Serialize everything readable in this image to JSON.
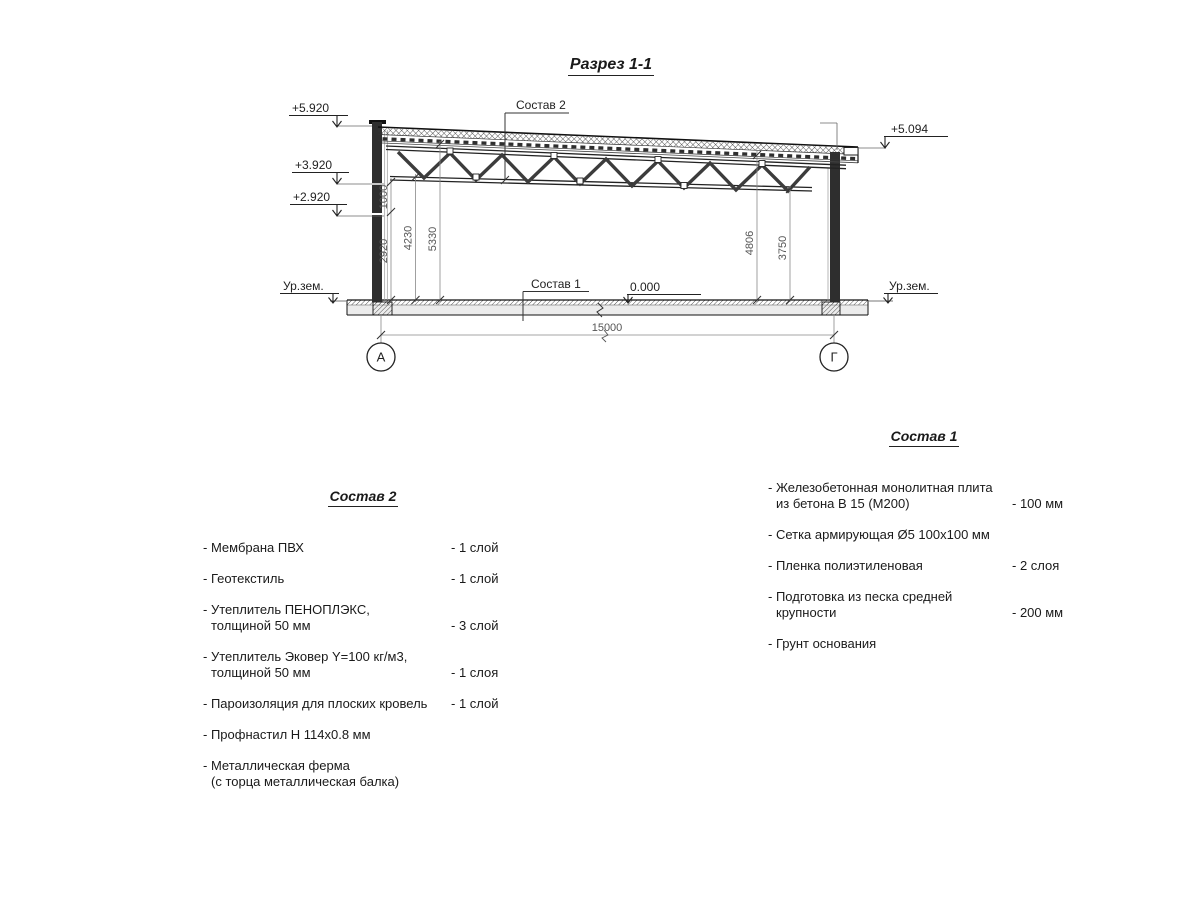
{
  "title": "Разрез 1-1",
  "section": {
    "elevations": {
      "left_top": "+5.920",
      "left_mid": "+3.920",
      "left_low": "+2.920",
      "right_top": "+5.094",
      "zero": "0.000"
    },
    "ground_level_left": "Ур.зем.",
    "ground_level_right": "Ур.зем.",
    "callout_roof": "Состав 2",
    "callout_floor": "Состав 1",
    "dims": {
      "d1000": "1000",
      "d2920": "2920",
      "d4230": "4230",
      "d5330": "5330",
      "d4806": "4806",
      "d3750": "3750",
      "span": "15000"
    },
    "axes": {
      "left": "А",
      "right": "Г"
    }
  },
  "list2": {
    "heading": "Состав 2",
    "items": [
      {
        "text": "- Мембрана ПВХ",
        "value": "- 1 слой"
      },
      {
        "text": "- Геотекстиль",
        "value": "- 1 слой"
      },
      {
        "text": "- Утеплитель ПЕНОПЛЭКС,",
        "text2": "толщиной 50 мм",
        "value": "- 3 слой"
      },
      {
        "text": "- Утеплитель Эковер Y=100 кг/м3,",
        "text2": "толщиной 50 мм",
        "value": "- 1 слоя"
      },
      {
        "text": "- Пароизоляция для плоских кровель",
        "value": "- 1 слой"
      },
      {
        "text": "- Профнастил Н 114х0.8 мм"
      },
      {
        "text": "- Металлическая ферма",
        "text2": "(с торца металлическая балка)"
      }
    ]
  },
  "list1": {
    "heading": "Состав 1",
    "items": [
      {
        "text": "- Железобетонная монолитная плита",
        "text2": "из бетона В 15 (М200)",
        "value": "- 100 мм"
      },
      {
        "text": "- Сетка армирующая Ø5 100х100 мм"
      },
      {
        "text": "- Пленка полиэтиленовая",
        "value": "-  2 слоя"
      },
      {
        "text": "- Подготовка из песка средней",
        "text2": "крупности",
        "value": "- 200 мм"
      },
      {
        "text": "- Грунт основания"
      }
    ]
  }
}
